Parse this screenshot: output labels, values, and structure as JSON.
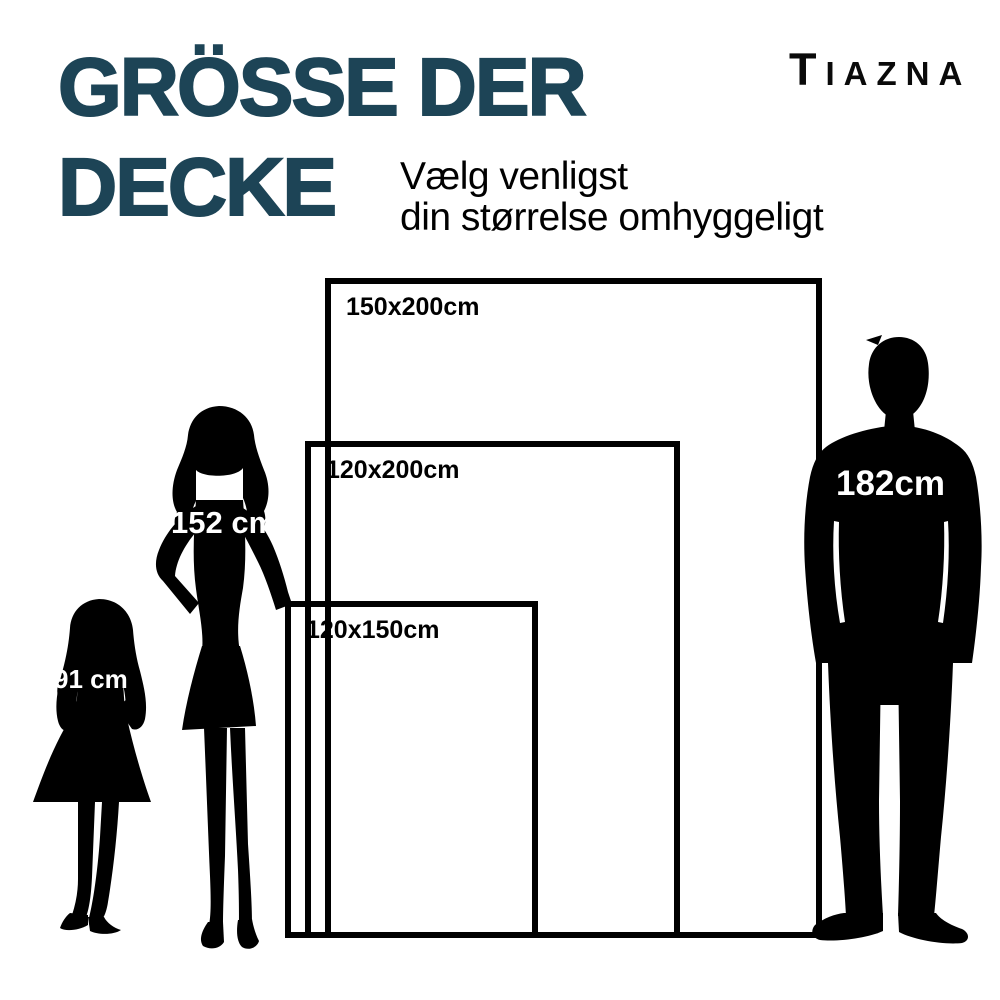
{
  "header": {
    "title_line1": "GRÖSSE DER",
    "title_line2": "DECKE",
    "subtitle_line1": "Vælg venligst",
    "subtitle_line2": "din størrelse omhyggeligt",
    "brand": "TIAZNA"
  },
  "diagram": {
    "sizes": [
      {
        "label": "150x200cm"
      },
      {
        "label": "120x200cm"
      },
      {
        "label": "120x150cm"
      }
    ],
    "figures": [
      {
        "name": "girl",
        "height_label": "91 cm"
      },
      {
        "name": "woman",
        "height_label": "152 cm"
      },
      {
        "name": "man",
        "height_label": "182cm"
      }
    ]
  },
  "colors": {
    "title": "#1d4456",
    "ink": "#000000",
    "background": "#ffffff",
    "figure_label": "#ffffff"
  }
}
